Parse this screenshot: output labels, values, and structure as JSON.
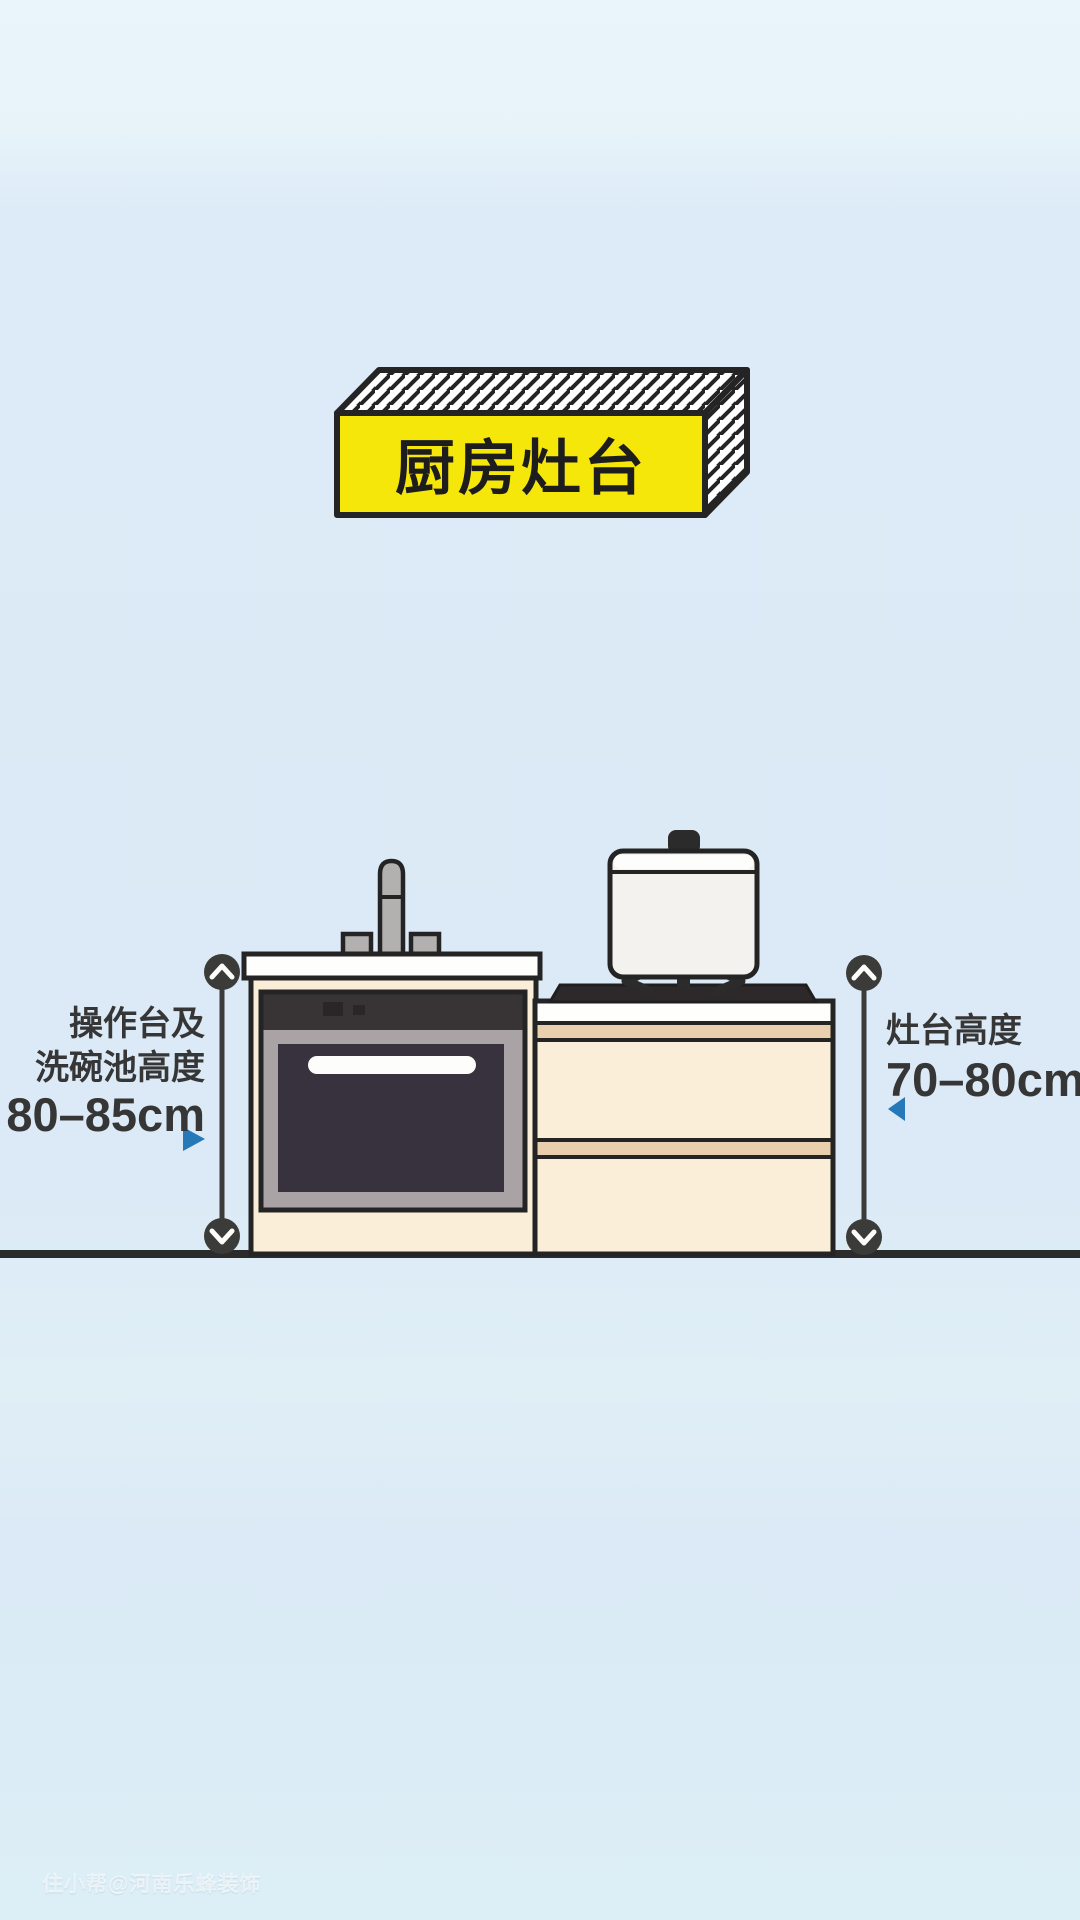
{
  "title": {
    "banner_label": "厨房灶台"
  },
  "labels": {
    "left": {
      "line1": "操作台及",
      "line2": "洗碗池高度",
      "value": "80–85cm"
    },
    "right": {
      "line1": "灶台高度",
      "value": "70–80cm"
    }
  },
  "watermark": {
    "text": "住小帮@河南乐蜂装饰"
  },
  "dimensions": {
    "counter_sink_height_cm": "80–85",
    "stove_height_cm": "70–80"
  },
  "colors": {
    "banner_yellow": "#f6e70a",
    "accent_blue": "#2679b8",
    "outline_dark": "#242424",
    "cabinet_cream": "#faeed9",
    "cabinet_tan": "#e9cfae",
    "countertop_white": "#fefefc",
    "steel_gray": "#b3b0b0",
    "oven_panel_dark": "#383335",
    "oven_frame_gray": "#a9a3a5",
    "oven_window_dark": "#37323d",
    "ground_dark": "#2b2b2b",
    "background_blue": "#dbeaf6"
  }
}
